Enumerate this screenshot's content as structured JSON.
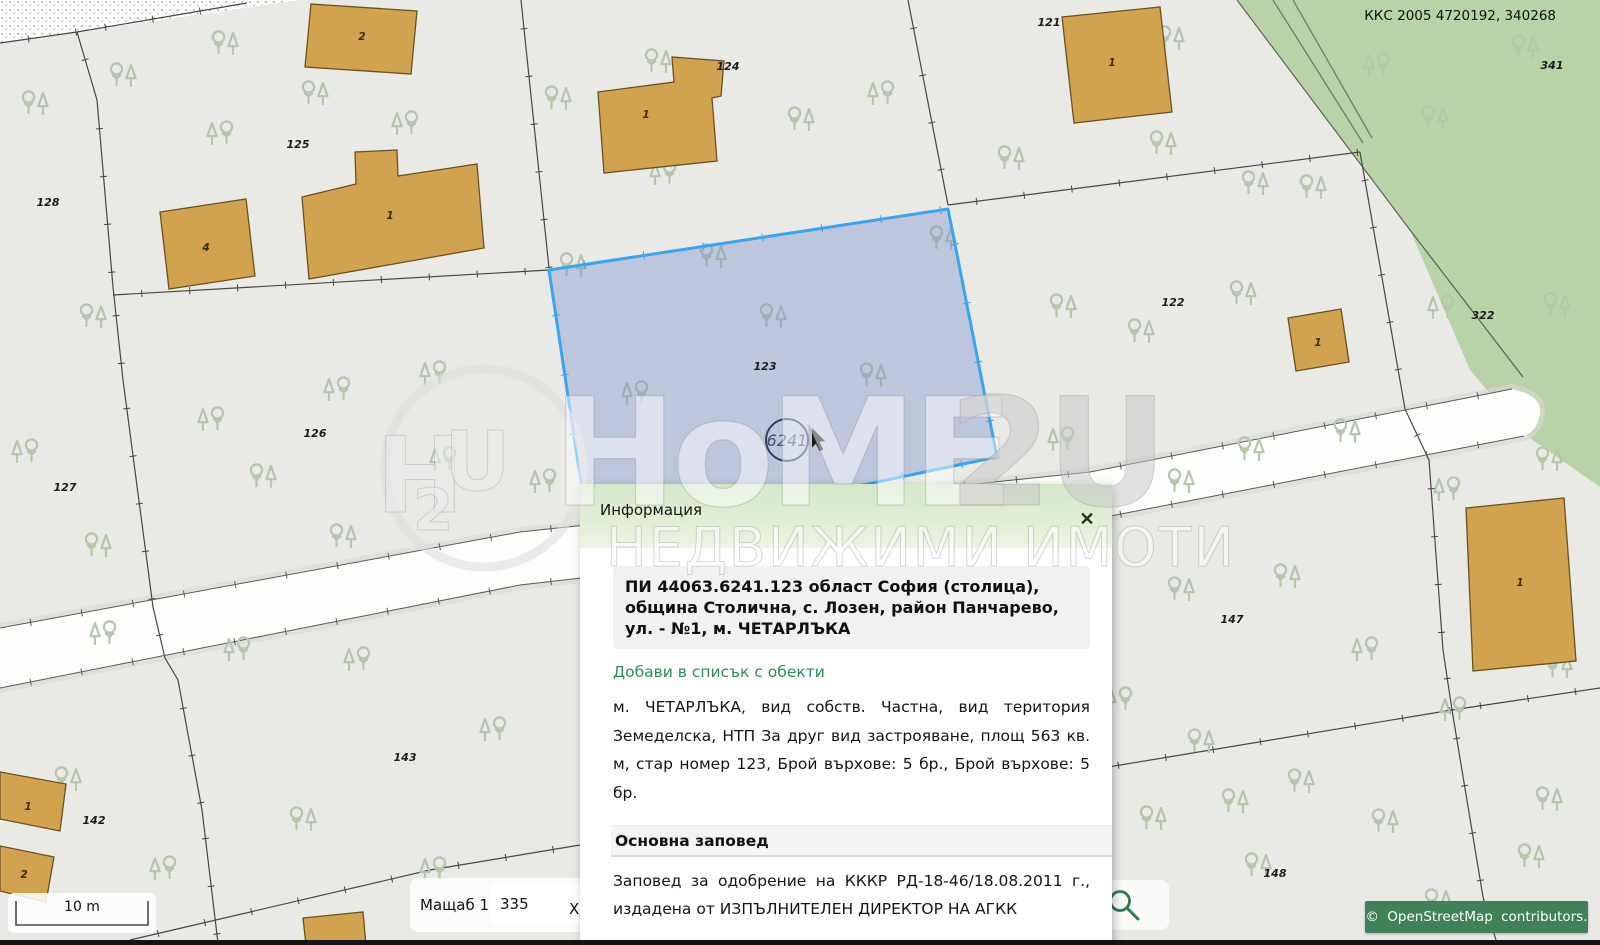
{
  "header": {
    "kks": "ККС 2005 4720192, 340268"
  },
  "map": {
    "circle_label": "6241",
    "parcel_labels": [
      {
        "t": "128",
        "x": 48,
        "y": 206
      },
      {
        "t": "125",
        "x": 298,
        "y": 148
      },
      {
        "t": "126",
        "x": 315,
        "y": 437
      },
      {
        "t": "127",
        "x": 65,
        "y": 491
      },
      {
        "t": "124",
        "x": 728,
        "y": 70
      },
      {
        "t": "121",
        "x": 1049,
        "y": 26
      },
      {
        "t": "122",
        "x": 1173,
        "y": 306
      },
      {
        "t": "123",
        "x": 765,
        "y": 370
      },
      {
        "t": "322",
        "x": 1483,
        "y": 319
      },
      {
        "t": "341",
        "x": 1552,
        "y": 69
      },
      {
        "t": "147",
        "x": 1232,
        "y": 623
      },
      {
        "t": "148",
        "x": 1275,
        "y": 877
      },
      {
        "t": "143",
        "x": 405,
        "y": 761
      },
      {
        "t": "142",
        "x": 94,
        "y": 824
      }
    ],
    "building_labels": [
      {
        "t": "2",
        "x": 362,
        "y": 40
      },
      {
        "t": "4",
        "x": 206,
        "y": 251
      },
      {
        "t": "1",
        "x": 390,
        "y": 219
      },
      {
        "t": "1",
        "x": 646,
        "y": 118
      },
      {
        "t": "1",
        "x": 1112,
        "y": 66
      },
      {
        "t": "1",
        "x": 1318,
        "y": 346
      },
      {
        "t": "1",
        "x": 1520,
        "y": 586
      },
      {
        "t": "1",
        "x": 28,
        "y": 810
      },
      {
        "t": "2",
        "x": 24,
        "y": 878
      }
    ]
  },
  "popup": {
    "title": "Информация",
    "close": "✕",
    "address": "ПИ 44063.6241.123 област София (столица), община Столична, с. Лозен, район Панчарево, ул. - №1, м. ЧЕТАРЛЪКА",
    "link": "Добави в списък с обекти",
    "description": "м. ЧЕТАРЛЪКА, вид собств. Частна, вид територия Земеделска, НТП За друг вид застрояване, площ 563 кв. м, стар номер 123, Брой върхове: 5 бр., Брой върхове: 5 бр.",
    "section_title": "Основна заповед",
    "order_text": "Заповед за одобрение на КККР РД-18-46/18.08.2011 г., издадена от ИЗПЪЛНИТЕЛЕН ДИРЕКТОР НА АГКК"
  },
  "controls": {
    "scalebar": "10 m",
    "scale_label": "Мащаб 1:",
    "scale_value": "335",
    "x_label": "X"
  },
  "attribution": "© OpenStreetMap contributors.",
  "watermark": {
    "brand_left": "HoME",
    "brand_right": "2U",
    "subtitle": "НЕДВИЖИМИ ИМОТИ",
    "logo_h": "H",
    "logo_2": "2",
    "logo_u": "U"
  },
  "colors": {
    "accent_blue": "#3aa4ef",
    "selected_fill": "rgba(110,136,204,0.35)",
    "building_fill": "#d1a34e",
    "green_area": "#b8d3a8",
    "attribution_bg": "#3f8159",
    "link_green": "#2e8b57"
  }
}
